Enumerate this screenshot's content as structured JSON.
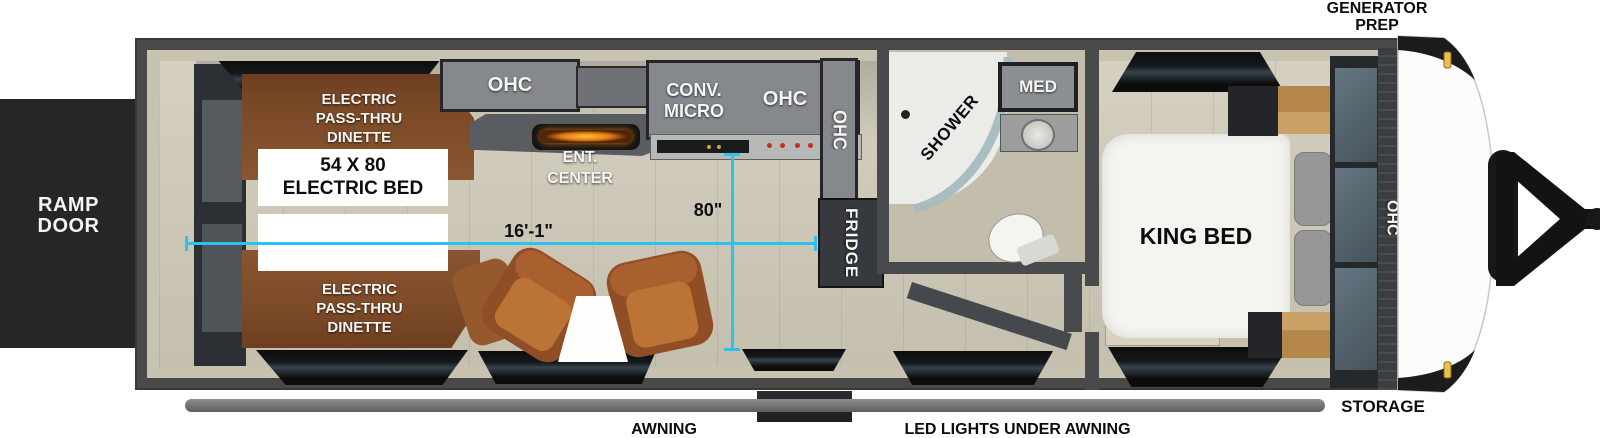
{
  "plan": {
    "ramp_door": {
      "l1": "RAMP",
      "l2": "DOOR"
    },
    "dinette_top": {
      "l1": "ELECTRIC",
      "l2": "PASS-THRU",
      "l3": "DINETTE"
    },
    "dinette_bottom": {
      "l1": "ELECTRIC",
      "l2": "PASS-THRU",
      "l3": "DINETTE"
    },
    "electric_bed": {
      "l1": "54 X 80",
      "l2": "ELECTRIC BED"
    },
    "ohc_top": "OHC",
    "ent_center": {
      "l1": "ENT.",
      "l2": "CENTER"
    },
    "conv_micro": {
      "l1": "CONV.",
      "l2": "MICRO"
    },
    "ohc_mid": "OHC",
    "ohc_kitchen_end": "OHC",
    "fridge": "FRIDGE",
    "shower": "SHOWER",
    "shower_pointer": "–",
    "med": "MED",
    "king_bed": "KING BED",
    "ohc_bedroom_front": "OHC",
    "generator_prep": {
      "l1": "GENERATOR",
      "l2": "PREP"
    },
    "storage": "STORAGE",
    "awning": "AWNING",
    "led_lights": "LED LIGHTS UNDER AWNING",
    "dimensions": {
      "length": "16'-1\"",
      "width": "80\""
    }
  },
  "colors": {
    "dimension_line": "#2bc2ee",
    "dinette_wood": "#7b4a28",
    "chair_brown": "#a9602e",
    "cabinet_gray": "#85888c",
    "frame_gray": "#4a4947",
    "wall_beige": "#c8c3b1",
    "floor_beige": "#cfc9b7",
    "marker_light_amber": "#eebd52",
    "fireplace_glow": "#ffb22e"
  }
}
